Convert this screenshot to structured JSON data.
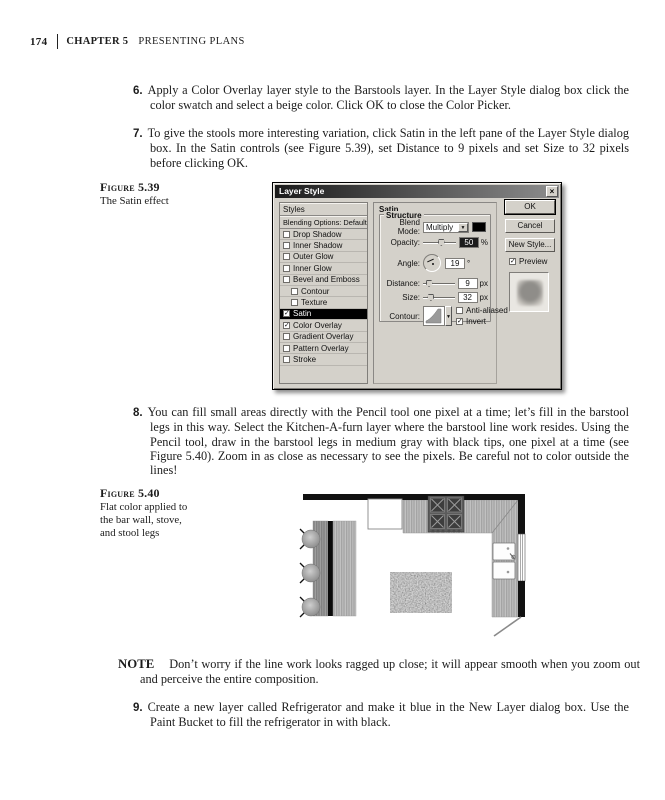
{
  "page": {
    "number": "174",
    "chapter": "CHAPTER 5",
    "chapter_title": "PRESENTING PLANS"
  },
  "steps": [
    {
      "num": "6.",
      "text": "Apply a Color Overlay layer style to the Barstools layer. In the Layer Style dialog box click the color swatch and select a beige color. Click OK to close the Color Picker."
    },
    {
      "num": "7.",
      "text": "To give the stools more interesting variation, click Satin in the left pane of the Layer Style dialog box. In the Satin controls (see Figure 5.39), set Distance to 9 pixels and set Size to 32 pixels before clicking OK."
    },
    {
      "num": "8.",
      "text": "You can fill small areas directly with the Pencil tool one pixel at a time; let’s fill in the barstool legs in this way. Select the Kitchen-A-furn layer where the barstool line work resides. Using the Pencil tool, draw in the barstool legs in medium gray with black tips, one pixel at a time (see Figure 5.40). Zoom in as close as necessary to see the pixels. Be careful not to color outside the lines!"
    },
    {
      "num": "9.",
      "text": "Create a new layer called Refrigerator and make it blue in the New Layer dialog box. Use the Paint Bucket to fill the refrigerator in with black."
    }
  ],
  "figures": [
    {
      "label": "Figure 5.39",
      "caption": "The Satin effect"
    },
    {
      "label": "Figure 5.40",
      "caption": "Flat color applied to the bar wall, stove, and stool legs"
    }
  ],
  "note": {
    "label": "NOTE",
    "text": "Don’t worry if the line work looks ragged up close; it will appear smooth when you zoom out and perceive the entire composition."
  },
  "dialog": {
    "title": "Layer Style",
    "left_pane": {
      "styles_label": "Styles",
      "blending_label": "Blending Options: Default",
      "items": [
        {
          "label": "Drop Shadow",
          "checked": false
        },
        {
          "label": "Inner Shadow",
          "checked": false
        },
        {
          "label": "Outer Glow",
          "checked": false
        },
        {
          "label": "Inner Glow",
          "checked": false
        },
        {
          "label": "Bevel and Emboss",
          "checked": false
        },
        {
          "label": "Contour",
          "checked": false,
          "indent": true
        },
        {
          "label": "Texture",
          "checked": false,
          "indent": true
        },
        {
          "label": "Satin",
          "checked": true,
          "selected": true
        },
        {
          "label": "Color Overlay",
          "checked": true
        },
        {
          "label": "Gradient Overlay",
          "checked": false
        },
        {
          "label": "Pattern Overlay",
          "checked": false
        },
        {
          "label": "Stroke",
          "checked": false
        }
      ]
    },
    "panel": {
      "group_title": "Satin",
      "structure_title": "Structure",
      "blend_mode_label": "Blend Mode:",
      "blend_mode_value": "Multiply",
      "opacity_label": "Opacity:",
      "opacity_value": "50",
      "opacity_unit": "%",
      "angle_label": "Angle:",
      "angle_value": "19",
      "angle_unit": "°",
      "distance_label": "Distance:",
      "distance_value": "9",
      "distance_unit": "px",
      "size_label": "Size:",
      "size_value": "32",
      "size_unit": "px",
      "contour_label": "Contour:",
      "antialiased_label": "Anti-aliased",
      "antialiased_checked": false,
      "invert_label": "Invert",
      "invert_checked": true
    },
    "buttons": {
      "ok": "OK",
      "cancel": "Cancel",
      "new_style": "New Style...",
      "preview_label": "Preview",
      "preview_checked": true
    }
  },
  "glyphs": {
    "check": "✓",
    "dropdown_arrow": "▼",
    "close": "×"
  },
  "colors": {
    "page_bg": "#ffffff",
    "body_text": "#1c1c1c",
    "dialog_bg": "#d4d1ca",
    "titlebar_dark": "#1b1b1b",
    "titlebar_light": "#8d8d8d",
    "selected_row_bg": "#000000",
    "wall_black": "#111111",
    "counter_gray": "#b7b7b7",
    "stove_gray": "#5c5c5c"
  }
}
